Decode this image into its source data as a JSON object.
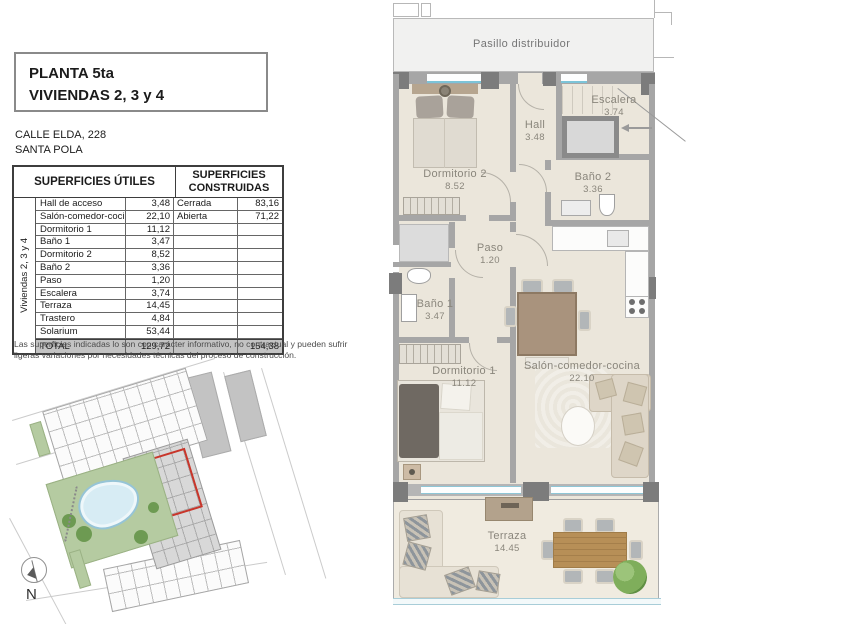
{
  "doc": {
    "title_line1": "PLANTA 5ta",
    "title_line2": "VIVIENDAS 2, 3 y 4",
    "address_line1": "CALLE ELDA, 228",
    "address_line2": "SANTA POLA",
    "disclaimer_line1": "Las superficies indicadas lo son con carácter informativo, no contractual y pueden sufrir",
    "disclaimer_line2": "ligeras variaciones por necesidades técnicas del proceso de construcción."
  },
  "table": {
    "header_utiles": "SUPERFICIES ÚTILES",
    "header_construidas": "SUPERFICIES CONSTRUIDAS",
    "side_label": "Viviendas 2, 3 y 4",
    "rows": [
      {
        "name": "Hall de acceso",
        "value": "3,48",
        "cname": "Cerrada",
        "cvalue": "83,16"
      },
      {
        "name": "Salón-comedor-cocina",
        "value": "22,10",
        "cname": "Abierta",
        "cvalue": "71,22"
      },
      {
        "name": "Dormitorio 1",
        "value": "11,12",
        "cname": "",
        "cvalue": ""
      },
      {
        "name": "Baño 1",
        "value": "3,47",
        "cname": "",
        "cvalue": ""
      },
      {
        "name": "Dormitorio 2",
        "value": "8,52",
        "cname": "",
        "cvalue": ""
      },
      {
        "name": "Baño 2",
        "value": "3,36",
        "cname": "",
        "cvalue": ""
      },
      {
        "name": "Paso",
        "value": "1,20",
        "cname": "",
        "cvalue": ""
      },
      {
        "name": "Escalera",
        "value": "3,74",
        "cname": "",
        "cvalue": ""
      },
      {
        "name": "Terraza",
        "value": "14,45",
        "cname": "",
        "cvalue": ""
      },
      {
        "name": "Trastero",
        "value": "4,84",
        "cname": "",
        "cvalue": ""
      },
      {
        "name": "Solarium",
        "value": "53,44",
        "cname": "",
        "cvalue": ""
      }
    ],
    "total": {
      "name": "TOTAL",
      "value": "129,72",
      "cname": "",
      "cvalue": "154,38"
    }
  },
  "plan": {
    "rooms": [
      {
        "id": "pasillo",
        "label": "Pasillo distribuidor",
        "area": ""
      },
      {
        "id": "dormitorio2",
        "label": "Dormitorio 2",
        "area": "8.52"
      },
      {
        "id": "hall",
        "label": "Hall",
        "area": "3.48"
      },
      {
        "id": "escalera",
        "label": "Escalera",
        "area": "3.74"
      },
      {
        "id": "bano2",
        "label": "Baño 2",
        "area": "3.36"
      },
      {
        "id": "paso",
        "label": "Paso",
        "area": "1.20"
      },
      {
        "id": "bano1",
        "label": "Baño 1",
        "area": "3.47"
      },
      {
        "id": "dormitorio1",
        "label": "Dormitorio 1",
        "area": "11.12"
      },
      {
        "id": "salon",
        "label": "Salón-comedor-cocina",
        "area": "22.10"
      },
      {
        "id": "terraza",
        "label": "Terraza",
        "area": "14.45"
      }
    ]
  },
  "site_map": {
    "compass_label": "N"
  },
  "colors": {
    "wall_gray": "#a6a6a6",
    "pillar_gray": "#7c7c7c",
    "floor_beige": "#ebe6db",
    "terrace_beige": "#f0ebe0",
    "window_cyan": "#7cc4d8",
    "highlight_red": "#c8362b",
    "pool_blue": "#d7ecf4",
    "park_green": "#b5cba1",
    "total_row_gray": "#c3c3c3",
    "label_gray": "#8a867c"
  }
}
